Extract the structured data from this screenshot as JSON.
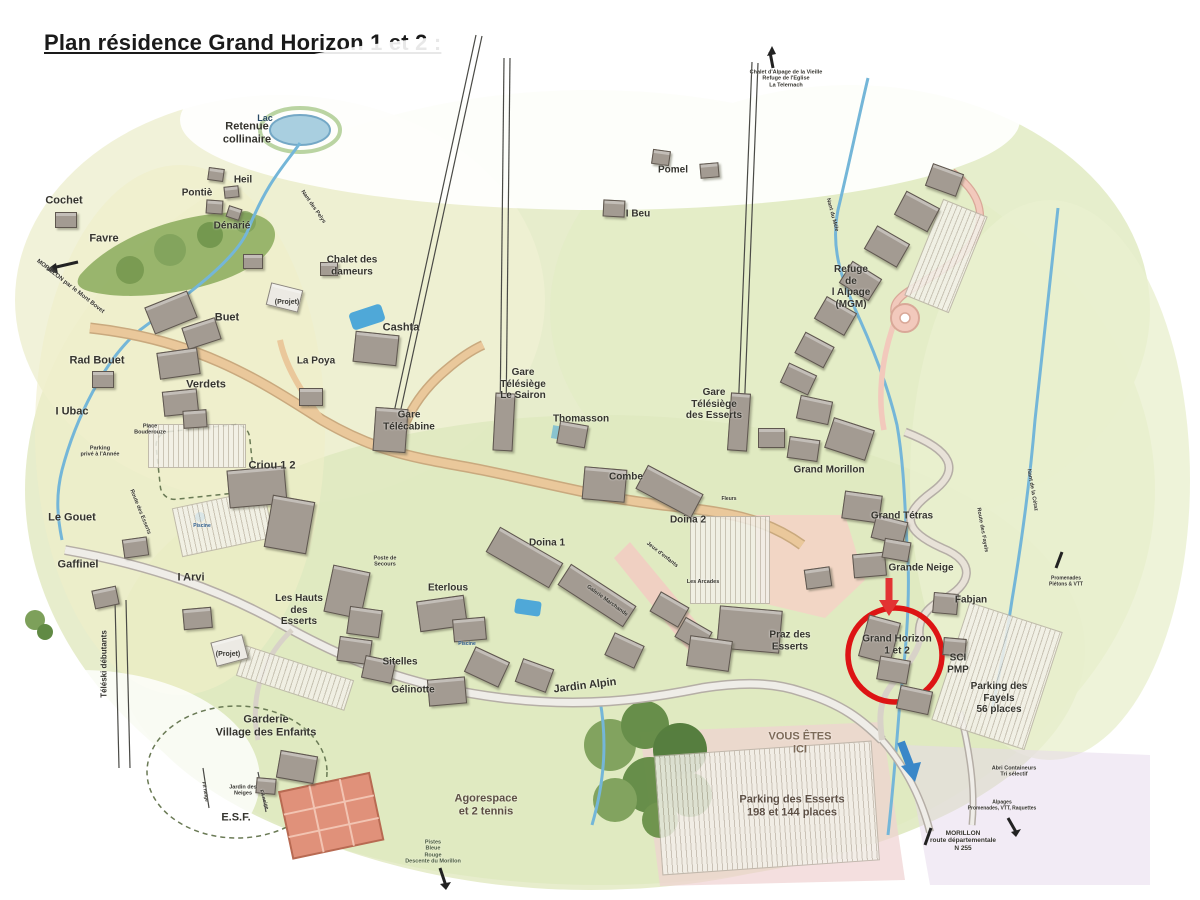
{
  "page": {
    "title": "Plan résidence Grand Horizon 1 et 2 :"
  },
  "colors": {
    "accent_red": "#dd1414",
    "arrow_red": "#e23333",
    "water_blue": "#74b6d8",
    "road_tan": "#eac89b",
    "road_gray": "#efede8",
    "terrain_green": "#e7edcc",
    "forest_green": "#7da05a",
    "pink_zone": "#f4d2c6"
  },
  "highlight": {
    "label": "Grand Horizon\n1 et 2",
    "circled": true
  },
  "you_are_here": "VOUS ÊTES\nICI",
  "labels": [
    {
      "id": "lac",
      "t": "Lac",
      "x": 265,
      "y": 118,
      "fs": 9,
      "c": "#2a4a66"
    },
    {
      "id": "retenue-collinaire",
      "t": "Retenue\ncollinaire",
      "x": 247,
      "y": 133,
      "fs": 11
    },
    {
      "id": "heil",
      "t": "Heil",
      "x": 243,
      "y": 180,
      "fs": 10
    },
    {
      "id": "pontie",
      "t": "Pontiè",
      "x": 197,
      "y": 193,
      "fs": 10
    },
    {
      "id": "denarie",
      "t": "Dénarié",
      "x": 232,
      "y": 226,
      "fs": 10
    },
    {
      "id": "cochet",
      "t": "Cochet",
      "x": 64,
      "y": 201,
      "fs": 11
    },
    {
      "id": "favre",
      "t": "Favre",
      "x": 104,
      "y": 239,
      "fs": 11
    },
    {
      "id": "road-morillon-mont-bovet",
      "t": "MORILLON par le Mont Bovet",
      "x": 70,
      "y": 287,
      "fs": 6,
      "rot": 38
    },
    {
      "id": "chalet-des-dameurs",
      "t": "Chalet des\ndameurs",
      "x": 352,
      "y": 266,
      "fs": 10
    },
    {
      "id": "buet",
      "t": "Buet",
      "x": 227,
      "y": 318,
      "fs": 11
    },
    {
      "id": "projet-1",
      "t": "(Projet)",
      "x": 287,
      "y": 303,
      "fs": 7
    },
    {
      "id": "rad-bouet",
      "t": "Rad Bouet",
      "x": 97,
      "y": 361,
      "fs": 11
    },
    {
      "id": "verdets",
      "t": "Verdets",
      "x": 206,
      "y": 385,
      "fs": 11
    },
    {
      "id": "i-ubac",
      "t": "I Ubac",
      "x": 72,
      "y": 412,
      "fs": 11
    },
    {
      "id": "parking-prive",
      "t": "Parking\nprivé à l'Année",
      "x": 100,
      "y": 452,
      "fs": 5.5
    },
    {
      "id": "place-bouderouze",
      "t": "Place\nBouderouze",
      "x": 150,
      "y": 430,
      "fs": 5.5
    },
    {
      "id": "la-poya",
      "t": "La Poya",
      "x": 316,
      "y": 361,
      "fs": 10
    },
    {
      "id": "cashta",
      "t": "Cashta",
      "x": 401,
      "y": 328,
      "fs": 11
    },
    {
      "id": "gare-telecabine",
      "t": "Gare\nTélécabine",
      "x": 409,
      "y": 421,
      "fs": 10
    },
    {
      "id": "gare-telesiege-le-sairon",
      "t": "Gare\nTélésiège\nLe Sairon",
      "x": 523,
      "y": 384,
      "fs": 10
    },
    {
      "id": "thomasson",
      "t": "Thomasson",
      "x": 581,
      "y": 419,
      "fs": 10
    },
    {
      "id": "combe",
      "t": "Combe",
      "x": 626,
      "y": 477,
      "fs": 10
    },
    {
      "id": "pomel",
      "t": "Pomel",
      "x": 673,
      "y": 170,
      "fs": 10
    },
    {
      "id": "i-beu",
      "t": "I Beu",
      "x": 638,
      "y": 214,
      "fs": 10
    },
    {
      "id": "chalet-alpage-vieille",
      "t": "Chalet d'Alpage de la Vieille\nRefuge de l'Eglise\nLa Telernach",
      "x": 786,
      "y": 79,
      "fs": 5.5
    },
    {
      "id": "gare-telesiege-des-esserts",
      "t": "Gare\nTélésiège\ndes Esserts",
      "x": 714,
      "y": 404,
      "fs": 10
    },
    {
      "id": "refuge-alpage-mgm",
      "t": "Refuge\nde\nl Alpage\n(MGM)",
      "x": 851,
      "y": 287,
      "fs": 10
    },
    {
      "id": "nant-du-mele",
      "t": "Nant du Méle",
      "x": 832,
      "y": 215,
      "fs": 5.5,
      "rot": 75
    },
    {
      "id": "nant-des-pelys",
      "t": "Nant des Pelys",
      "x": 313,
      "y": 207,
      "fs": 5.5,
      "rot": 55
    },
    {
      "id": "grand-morillon",
      "t": "Grand Morillon",
      "x": 829,
      "y": 470,
      "fs": 10
    },
    {
      "id": "grand-tetras",
      "t": "Grand Tétras",
      "x": 902,
      "y": 516,
      "fs": 10
    },
    {
      "id": "route-des-fayels",
      "t": "Route des Fayels",
      "x": 982,
      "y": 530,
      "fs": 5.5,
      "rot": 80
    },
    {
      "id": "nant-de-la-cetaz",
      "t": "Nant de la Cétaz",
      "x": 1032,
      "y": 490,
      "fs": 5.5,
      "rot": 80
    },
    {
      "id": "grande-neige",
      "t": "Grande Neige",
      "x": 921,
      "y": 568,
      "fs": 10
    },
    {
      "id": "fabjan",
      "t": "Fabjan",
      "x": 971,
      "y": 600,
      "fs": 10
    },
    {
      "id": "grand-horizon-1-et-2",
      "t": "Grand Horizon\n1 et 2",
      "x": 897,
      "y": 645,
      "fs": 10
    },
    {
      "id": "sci-pmp",
      "t": "SCI\nPMP",
      "x": 958,
      "y": 664,
      "fs": 10
    },
    {
      "id": "parking-des-fayels",
      "t": "Parking des\nFayels\n56 places",
      "x": 999,
      "y": 698,
      "fs": 10
    },
    {
      "id": "promenades-pietons-vtt",
      "t": "Promenades\nPiétons & VTT",
      "x": 1066,
      "y": 582,
      "fs": 5
    },
    {
      "id": "criou-1-2",
      "t": "Criou 1 2",
      "x": 272,
      "y": 466,
      "fs": 11
    },
    {
      "id": "le-gouet",
      "t": "Le Gouet",
      "x": 72,
      "y": 518,
      "fs": 11
    },
    {
      "id": "gaffinel",
      "t": "Gaffinel",
      "x": 78,
      "y": 565,
      "fs": 11
    },
    {
      "id": "i-arvi",
      "t": "I Arvi",
      "x": 191,
      "y": 578,
      "fs": 11
    },
    {
      "id": "les-hauts-des-esserts",
      "t": "Les Hauts\ndes\nEsserts",
      "x": 299,
      "y": 610,
      "fs": 10
    },
    {
      "id": "projet-2",
      "t": "(Projet)",
      "x": 228,
      "y": 655,
      "fs": 7
    },
    {
      "id": "teleski-debutants",
      "t": "Téléski débutants",
      "x": 104,
      "y": 664,
      "fs": 8,
      "rot": -90
    },
    {
      "id": "route-des-esserts",
      "t": "Route des Esserts",
      "x": 140,
      "y": 512,
      "fs": 5.5,
      "rot": 68
    },
    {
      "id": "poste-de-secours",
      "t": "Poste de\nSecours",
      "x": 385,
      "y": 562,
      "fs": 5.5
    },
    {
      "id": "doina-1",
      "t": "Doina 1",
      "x": 547,
      "y": 543,
      "fs": 10
    },
    {
      "id": "doina-2",
      "t": "Doina 2",
      "x": 688,
      "y": 520,
      "fs": 10
    },
    {
      "id": "fleurs",
      "t": "Fleurs",
      "x": 729,
      "y": 500,
      "fs": 5
    },
    {
      "id": "eterlous",
      "t": "Eterlous",
      "x": 448,
      "y": 588,
      "fs": 10
    },
    {
      "id": "piscine-1",
      "t": "Piscine",
      "x": 202,
      "y": 527,
      "fs": 5,
      "c": "#2a5a8a"
    },
    {
      "id": "piscine-2",
      "t": "Piscine",
      "x": 467,
      "y": 645,
      "fs": 5,
      "c": "#2a5a8a"
    },
    {
      "id": "sitelles",
      "t": "Sitelles",
      "x": 400,
      "y": 662,
      "fs": 10
    },
    {
      "id": "gelinotte",
      "t": "Gélinotte",
      "x": 413,
      "y": 690,
      "fs": 10
    },
    {
      "id": "jardin-alpin",
      "t": "Jardin Alpin",
      "x": 585,
      "y": 686,
      "fs": 11,
      "rot": -7
    },
    {
      "id": "les-arcades",
      "t": "Les Arcades",
      "x": 703,
      "y": 582,
      "fs": 5.5
    },
    {
      "id": "jeux-denfants",
      "t": "Jeux d'enfants",
      "x": 662,
      "y": 555,
      "fs": 5.5,
      "rot": 38
    },
    {
      "id": "galerie-marchande",
      "t": "Galerie Marchande",
      "x": 607,
      "y": 601,
      "fs": 5.5,
      "rot": 36
    },
    {
      "id": "praz-des-esserts",
      "t": "Praz des\nEsserts",
      "x": 790,
      "y": 641,
      "fs": 10
    },
    {
      "id": "vous-etes-ici",
      "t": "VOUS ÊTES\nICI",
      "x": 800,
      "y": 743,
      "fs": 11,
      "c": "#7c6a58"
    },
    {
      "id": "parking-des-esserts",
      "t": "Parking des Esserts\n198 et 144 places",
      "x": 792,
      "y": 806,
      "fs": 11,
      "c": "#5d4f44"
    },
    {
      "id": "agorespace",
      "t": "Agorespace\net 2 tennis",
      "x": 486,
      "y": 805,
      "fs": 11,
      "c": "#5d4f44"
    },
    {
      "id": "pistes-descente",
      "t": "Pistes\nBleue\nRouge\nDescente du Morillon",
      "x": 433,
      "y": 852,
      "fs": 5.5,
      "c": "#4a5a40"
    },
    {
      "id": "abri-containeurs",
      "t": "Abri Containeurs\nTri sélectif",
      "x": 1014,
      "y": 772,
      "fs": 5.5
    },
    {
      "id": "alpages-promenades",
      "t": "Alpages\nPromenades, VTT, Raquettes",
      "x": 1002,
      "y": 806,
      "fs": 5
    },
    {
      "id": "morillon-n255",
      "t": "MORILLON\nroute départementale\nN 255",
      "x": 963,
      "y": 841,
      "fs": 6.5
    },
    {
      "id": "garderie-village-enfants",
      "t": "Garderie\nVillage des Enfants",
      "x": 266,
      "y": 726,
      "fs": 11
    },
    {
      "id": "jardin-des-neiges",
      "t": "Jardin des\nNeiges",
      "x": 243,
      "y": 791,
      "fs": 5.5
    },
    {
      "id": "esf",
      "t": "E.S.F.",
      "x": 236,
      "y": 818,
      "fs": 11
    },
    {
      "id": "fil-neige-1",
      "t": "Fil neige",
      "x": 204,
      "y": 792,
      "fs": 5,
      "rot": 80
    },
    {
      "id": "fil-neige-2",
      "t": "Fil neige",
      "x": 263,
      "y": 800,
      "fs": 5,
      "rot": 72
    }
  ],
  "buildings": [
    {
      "x": 55,
      "y": 212,
      "w": 20,
      "h": 14,
      "r": 0
    },
    {
      "x": 243,
      "y": 254,
      "w": 18,
      "h": 13,
      "r": 0
    },
    {
      "x": 208,
      "y": 168,
      "w": 14,
      "h": 11,
      "r": 8
    },
    {
      "x": 224,
      "y": 186,
      "w": 13,
      "h": 10,
      "r": -6
    },
    {
      "x": 206,
      "y": 200,
      "w": 15,
      "h": 12,
      "r": 4
    },
    {
      "x": 227,
      "y": 207,
      "w": 12,
      "h": 10,
      "r": 18
    },
    {
      "x": 320,
      "y": 262,
      "w": 16,
      "h": 12,
      "r": 0
    },
    {
      "x": 652,
      "y": 150,
      "w": 16,
      "h": 13,
      "r": 8
    },
    {
      "x": 700,
      "y": 163,
      "w": 17,
      "h": 13,
      "r": -5
    },
    {
      "x": 603,
      "y": 200,
      "w": 20,
      "h": 15,
      "r": 3
    },
    {
      "x": 148,
      "y": 298,
      "w": 44,
      "h": 27,
      "r": -22
    },
    {
      "x": 184,
      "y": 322,
      "w": 33,
      "h": 21,
      "r": -18
    },
    {
      "x": 268,
      "y": 286,
      "w": 31,
      "h": 21,
      "r": 14,
      "l": 1
    },
    {
      "x": 158,
      "y": 350,
      "w": 39,
      "h": 25,
      "r": -8
    },
    {
      "x": 163,
      "y": 390,
      "w": 33,
      "h": 23,
      "r": -6
    },
    {
      "x": 92,
      "y": 371,
      "w": 20,
      "h": 15,
      "r": 0
    },
    {
      "x": 183,
      "y": 410,
      "w": 22,
      "h": 16,
      "r": -4
    },
    {
      "x": 299,
      "y": 388,
      "w": 22,
      "h": 16,
      "r": 0
    },
    {
      "x": 354,
      "y": 333,
      "w": 42,
      "h": 29,
      "r": 6
    },
    {
      "x": 374,
      "y": 408,
      "w": 31,
      "h": 42,
      "r": 4
    },
    {
      "x": 494,
      "y": 393,
      "w": 18,
      "h": 56,
      "r": 3
    },
    {
      "x": 558,
      "y": 423,
      "w": 27,
      "h": 21,
      "r": 10
    },
    {
      "x": 729,
      "y": 393,
      "w": 18,
      "h": 56,
      "r": 4
    },
    {
      "x": 928,
      "y": 168,
      "w": 31,
      "h": 22,
      "r": 20
    },
    {
      "x": 898,
      "y": 198,
      "w": 36,
      "h": 25,
      "r": 28
    },
    {
      "x": 868,
      "y": 233,
      "w": 36,
      "h": 25,
      "r": 30
    },
    {
      "x": 843,
      "y": 268,
      "w": 33,
      "h": 24,
      "r": 32
    },
    {
      "x": 818,
      "y": 303,
      "w": 33,
      "h": 24,
      "r": 30
    },
    {
      "x": 798,
      "y": 338,
      "w": 31,
      "h": 22,
      "r": 28
    },
    {
      "x": 783,
      "y": 368,
      "w": 29,
      "h": 20,
      "r": 25
    },
    {
      "x": 798,
      "y": 398,
      "w": 31,
      "h": 22,
      "r": 12
    },
    {
      "x": 828,
      "y": 423,
      "w": 41,
      "h": 30,
      "r": 18
    },
    {
      "x": 788,
      "y": 438,
      "w": 29,
      "h": 20,
      "r": 8
    },
    {
      "x": 758,
      "y": 428,
      "w": 25,
      "h": 18,
      "r": 0
    },
    {
      "x": 843,
      "y": 493,
      "w": 36,
      "h": 26,
      "r": 8
    },
    {
      "x": 873,
      "y": 518,
      "w": 31,
      "h": 22,
      "r": 14
    },
    {
      "x": 853,
      "y": 553,
      "w": 31,
      "h": 22,
      "r": -5
    },
    {
      "x": 883,
      "y": 540,
      "w": 25,
      "h": 18,
      "r": 10
    },
    {
      "x": 863,
      "y": 618,
      "w": 31,
      "h": 41,
      "r": 15
    },
    {
      "x": 878,
      "y": 658,
      "w": 29,
      "h": 22,
      "r": 10
    },
    {
      "x": 898,
      "y": 688,
      "w": 31,
      "h": 22,
      "r": 12
    },
    {
      "x": 933,
      "y": 593,
      "w": 23,
      "h": 19,
      "r": 5
    },
    {
      "x": 943,
      "y": 638,
      "w": 21,
      "h": 16,
      "r": 5
    },
    {
      "x": 228,
      "y": 468,
      "w": 56,
      "h": 36,
      "r": -5
    },
    {
      "x": 268,
      "y": 498,
      "w": 41,
      "h": 51,
      "r": 10
    },
    {
      "x": 123,
      "y": 538,
      "w": 23,
      "h": 17,
      "r": -8
    },
    {
      "x": 93,
      "y": 588,
      "w": 23,
      "h": 17,
      "r": -12
    },
    {
      "x": 183,
      "y": 608,
      "w": 27,
      "h": 19,
      "r": -5
    },
    {
      "x": 328,
      "y": 568,
      "w": 36,
      "h": 46,
      "r": 12
    },
    {
      "x": 348,
      "y": 608,
      "w": 31,
      "h": 26,
      "r": 8
    },
    {
      "x": 213,
      "y": 638,
      "w": 31,
      "h": 23,
      "r": -15,
      "l": 1
    },
    {
      "x": 488,
      "y": 543,
      "w": 71,
      "h": 27,
      "r": 30
    },
    {
      "x": 638,
      "y": 478,
      "w": 61,
      "h": 25,
      "r": 28
    },
    {
      "x": 583,
      "y": 468,
      "w": 41,
      "h": 31,
      "r": 5
    },
    {
      "x": 418,
      "y": 598,
      "w": 46,
      "h": 29,
      "r": -8
    },
    {
      "x": 453,
      "y": 618,
      "w": 31,
      "h": 21,
      "r": -5
    },
    {
      "x": 338,
      "y": 638,
      "w": 31,
      "h": 23,
      "r": 8
    },
    {
      "x": 363,
      "y": 658,
      "w": 29,
      "h": 21,
      "r": 12
    },
    {
      "x": 558,
      "y": 583,
      "w": 76,
      "h": 23,
      "r": 33
    },
    {
      "x": 653,
      "y": 598,
      "w": 31,
      "h": 21,
      "r": 30
    },
    {
      "x": 678,
      "y": 623,
      "w": 29,
      "h": 21,
      "r": 30
    },
    {
      "x": 468,
      "y": 653,
      "w": 36,
      "h": 26,
      "r": 25
    },
    {
      "x": 518,
      "y": 663,
      "w": 31,
      "h": 23,
      "r": 20
    },
    {
      "x": 608,
      "y": 638,
      "w": 31,
      "h": 23,
      "r": 25
    },
    {
      "x": 718,
      "y": 608,
      "w": 61,
      "h": 41,
      "r": 5
    },
    {
      "x": 688,
      "y": 638,
      "w": 41,
      "h": 29,
      "r": 8
    },
    {
      "x": 278,
      "y": 753,
      "w": 36,
      "h": 26,
      "r": 10
    },
    {
      "x": 256,
      "y": 778,
      "w": 18,
      "h": 14,
      "r": 5
    },
    {
      "x": 428,
      "y": 678,
      "w": 36,
      "h": 25,
      "r": -5
    },
    {
      "x": 805,
      "y": 568,
      "w": 24,
      "h": 18,
      "r": -8
    }
  ],
  "parkings": [
    {
      "x": 148,
      "y": 424,
      "w": 96,
      "h": 42,
      "r": 0
    },
    {
      "x": 176,
      "y": 498,
      "w": 92,
      "h": 48,
      "r": -12
    },
    {
      "x": 690,
      "y": 516,
      "w": 78,
      "h": 86,
      "r": 0
    },
    {
      "x": 238,
      "y": 662,
      "w": 112,
      "h": 30,
      "r": 18
    },
    {
      "x": 948,
      "y": 614,
      "w": 96,
      "h": 122,
      "r": 18
    },
    {
      "x": 922,
      "y": 204,
      "w": 46,
      "h": 102,
      "r": 22
    },
    {
      "x": 658,
      "y": 748,
      "w": 216,
      "h": 118,
      "r": -4
    }
  ]
}
